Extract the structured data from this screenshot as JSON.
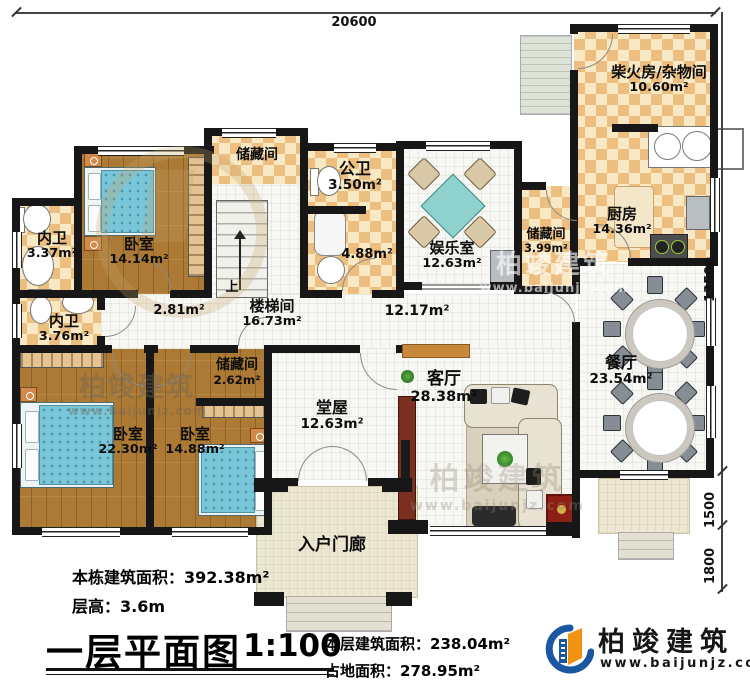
{
  "dimensions": {
    "top": "20600",
    "right_main": "13500",
    "right_mid": "1500",
    "right_low": "1800"
  },
  "rooms": {
    "chaihuo": {
      "name": "柴火房/杂物间",
      "area": "10.60m²"
    },
    "kitchen": {
      "name": "厨房",
      "area": "14.36m²"
    },
    "storage_r": {
      "name": "储藏间",
      "area": "3.99m²"
    },
    "dining": {
      "name": "餐厅",
      "area": "23.54m²"
    },
    "fun": {
      "name": "娱乐室",
      "area": "12.63m²"
    },
    "gongwei": {
      "name": "公卫",
      "area": "3.50m²"
    },
    "bath488": {
      "area": "4.88m²"
    },
    "storage_t": {
      "name": "储藏间"
    },
    "bed_t": {
      "name": "卧室",
      "area": "14.14m²"
    },
    "nw1": {
      "name": "内卫",
      "area": "3.37m²"
    },
    "nw2": {
      "name": "内卫",
      "area": "3.76m²"
    },
    "stair": {
      "name": "楼梯间",
      "area": "16.73m²",
      "up": "上"
    },
    "hall_l": {
      "area": "2.81m²"
    },
    "hall_r": {
      "area": "12.17m²"
    },
    "storage_s": {
      "name": "储藏间",
      "area": "2.62m²"
    },
    "bed_l": {
      "name": "卧室",
      "area": "22.30m²"
    },
    "bed_m": {
      "name": "卧室",
      "area": "14.88m²"
    },
    "tangwu": {
      "name": "堂屋",
      "area": "12.63m²"
    },
    "living": {
      "name": "客厅",
      "area": "28.38m²"
    },
    "porch": {
      "name": "入户门廊"
    }
  },
  "footer": {
    "building_area": "本栋建筑面积：392.38m²",
    "floor_height": "层高：3.6m",
    "title": "一层平面图",
    "scale": "1:100",
    "floor_area": "本层建筑面积：238.04m²",
    "land_area": "占地面积：278.95m²"
  },
  "logo": {
    "brand": "柏竣建筑",
    "url": "www.baijunjz.com"
  },
  "watermark": {
    "brand": "柏竣建筑",
    "url": "www.baijunjz.com"
  },
  "colors": {
    "logo_blue": "#1a57a0",
    "logo_orange": "#f29212",
    "wall": "#171717",
    "accent_beam": "#c8883c"
  }
}
